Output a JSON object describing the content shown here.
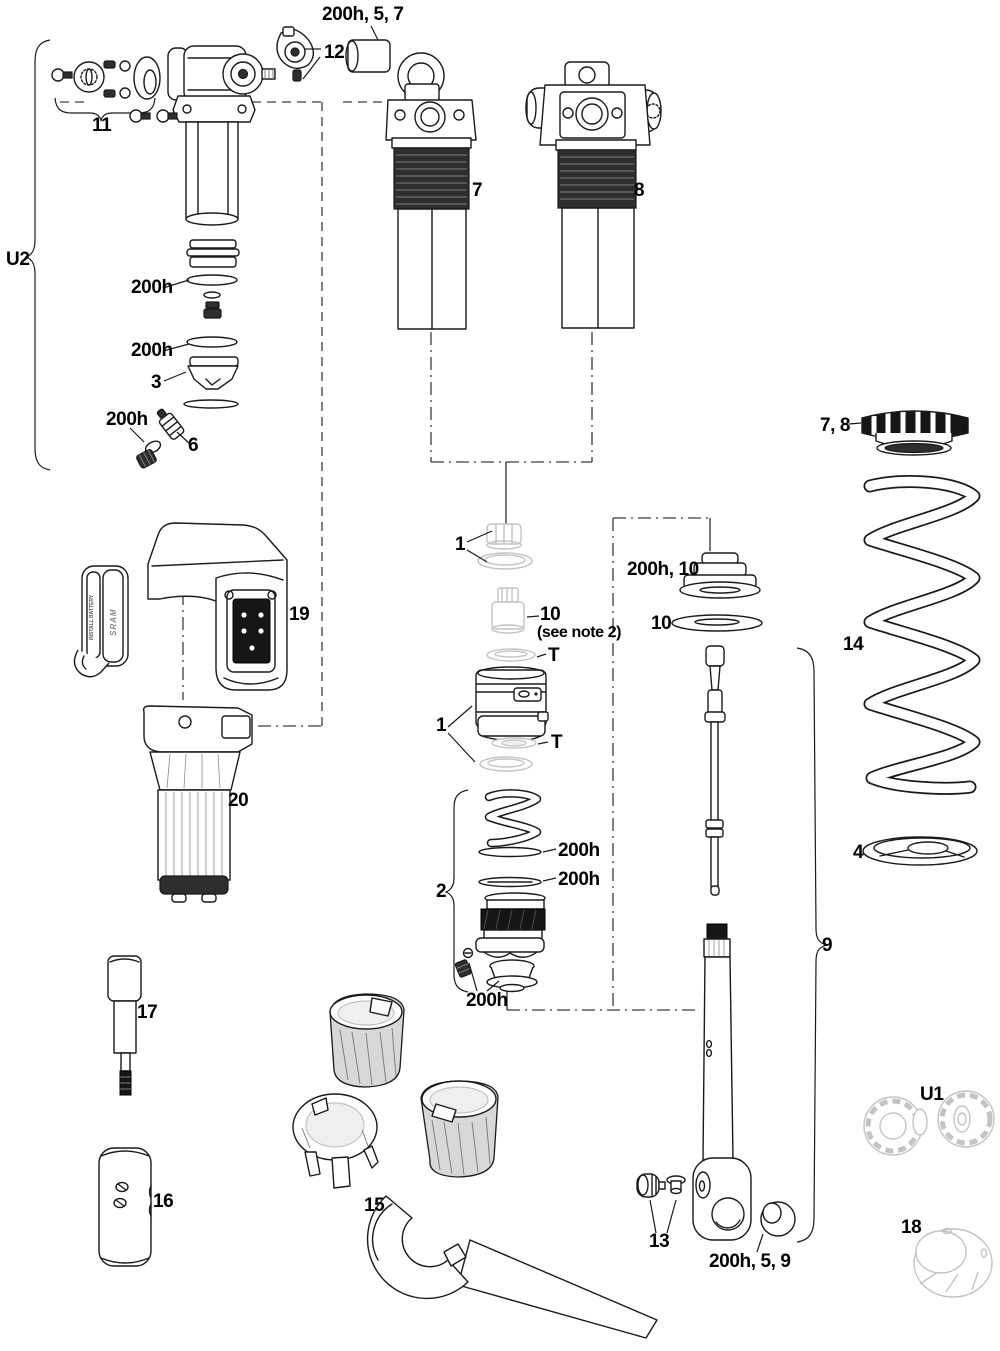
{
  "palette": {
    "ink": "#1a1a1a",
    "dark_fill": "#2e2e2e",
    "ghost": "#c3c3c3",
    "background": "#ffffff"
  },
  "diagram": {
    "labels": {
      "bushing_top": "200h, 5, 7",
      "remote_lever": "12",
      "mount_hardware": "11",
      "unit2": "U2",
      "service_200h": "200h",
      "seal_head": "3",
      "air_valve": "6",
      "shock_left": "7",
      "shock_right": "8",
      "spring_collar": "7, 8",
      "coil_spring": "14",
      "spring_seat": "4",
      "air_can_parts": "1",
      "shaft_valve": "10",
      "see_note": "(see note 2)",
      "t_marker": "T",
      "bumper": "200h, 10",
      "piston_group": "2",
      "damper_assembly": "9",
      "shaft_tool": "17",
      "sleeve_tool": "16",
      "wrench_tool": "15",
      "hardware_pair": "13",
      "eyelet_bushing": "200h, 5, 9",
      "unit1": "U1",
      "socket_cup": "18",
      "controller_module": "19",
      "motor_module": "20",
      "battery_note": "INSTALL BATTERY",
      "battery_brand": "SRAM"
    }
  }
}
